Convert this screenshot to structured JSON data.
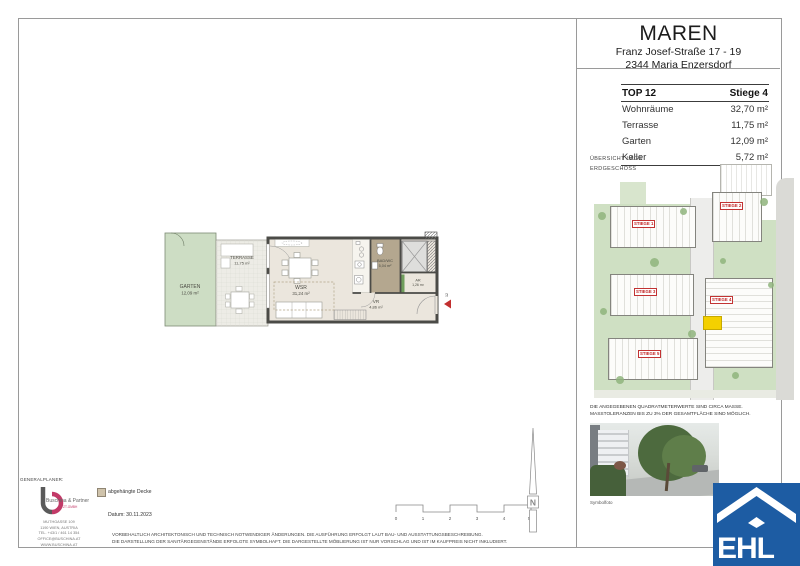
{
  "header": {
    "title": "MAREN",
    "address_line1": "Franz Josef-Straße 17 - 19",
    "address_line2": "2344 Maria Enzersdorf"
  },
  "unit_table": {
    "top_label": "TOP 12",
    "stiege_label": "Stiege 4",
    "rows": [
      {
        "label": "Wohnräume",
        "value": "32,70 m²"
      },
      {
        "label": "Terrasse",
        "value": "11,75 m²"
      },
      {
        "label": "Garten",
        "value": "12,09 m²"
      },
      {
        "label": "Keller",
        "value": "5,72 m²"
      }
    ]
  },
  "site_overview": {
    "caption_line1": "ÜBERSICHT LAGE",
    "caption_line2": "ERDGESCHOSS",
    "stiege_labels": [
      "STIEGE 1",
      "STIEGE 2",
      "STIEGE 3",
      "STIEGE 4",
      "STIEGE 5"
    ],
    "highlight_color": "#f4d000",
    "accent_red": "#c22323"
  },
  "floor_plan": {
    "rooms": [
      {
        "name": "GARTEN",
        "area": "12,09 m²"
      },
      {
        "name": "TERRASSE",
        "area": "11,75 m²"
      },
      {
        "name": "WSR",
        "area": "31,24 m²"
      },
      {
        "name": "BAD/WC",
        "area": "5,04 m²"
      },
      {
        "name": "AR",
        "area": "1,26 m²"
      },
      {
        "name": "VR",
        "area": "4,86 m²"
      }
    ],
    "entrance_number": "12"
  },
  "legend": {
    "suspended_ceiling": "abgehängte Decke",
    "swatch_color": "#cfc3ab",
    "date": "Datum: 30.11.2023"
  },
  "scale_bar": {
    "ticks": [
      "0",
      "1",
      "2",
      "3",
      "4",
      "5m"
    ]
  },
  "north_arrow": {
    "label": "N"
  },
  "notes": {
    "sqm_line1": "DIE ANGEGEBENEN QUADRATMETERWERTE SIND CIRCA MASSE.",
    "sqm_line2": "MASSTOLERANZEN BIS ZU 3% DER GESAMTFLÄCHE SIND MÖGLICH.",
    "photo_caption": "Symbolfoto",
    "disclaimer_line1": "VORBEHALTLICH ARCHITEKTONISCH UND TECHNISCH NOTWENDIGER ÄNDERUNGEN. DIE AUSFÜHRUNG ERFOLGT LAUT BAU- UND AUSSTATTUNGSBESCHREIBUNG.",
    "disclaimer_line2": "DIE DARSTELLUNG DER SANITÄRGEGENSTÄNDE ERFOLGTE SYMBOLHAFT. DIE DARGESTELLTE MÖBLIERUNG IST NUR VORSCHLAG UND IST IM KAUFPREIS NICHT INKLUDIERT."
  },
  "generalplaner": {
    "heading": "GENERALPLANER:",
    "company": "Buschina & Partner",
    "subtitle": "ZT-GMBH",
    "address_lines": [
      "MUTHGASSE 109",
      "1190 WIEN, AUSTRIA",
      "TEL. +43/1 / 461 14 354",
      "OFFICE@BUSCHINA.AT",
      "WWW.BUSCHINA.AT"
    ]
  },
  "ehl": {
    "text": "EHL",
    "blue": "#1d5ca3"
  }
}
